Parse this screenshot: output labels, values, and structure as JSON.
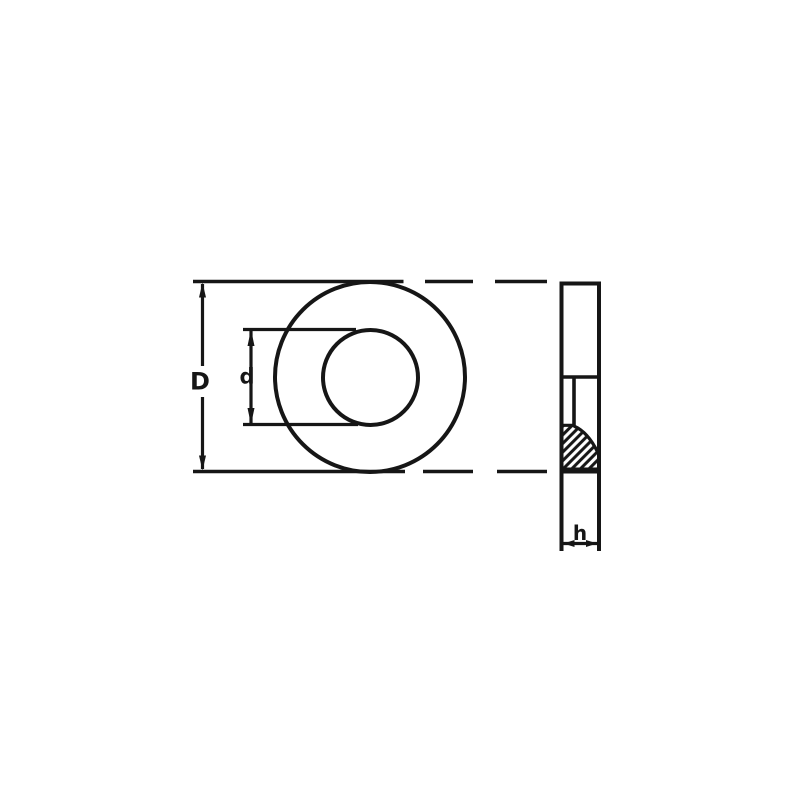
{
  "diagram": {
    "kind": "technical-drawing",
    "subject": "flat washer, front view with sectioned side view",
    "labels": {
      "outer_diameter": "D",
      "inner_diameter": "d",
      "thickness": "h"
    },
    "colors": {
      "ink": "#161616",
      "background": "#ffffff"
    }
  }
}
